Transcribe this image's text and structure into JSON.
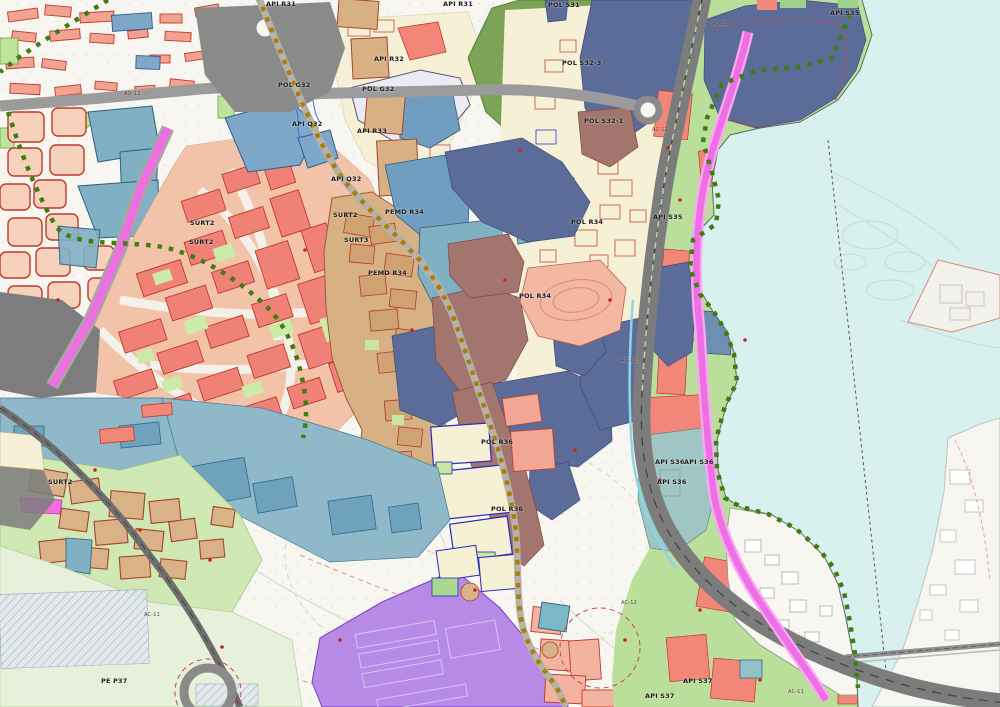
{
  "map": {
    "type": "urban-planning-zoning-map",
    "palette": {
      "water": "#d9f1ee",
      "paper": "#f8f6f0",
      "green_belt": "#b9df9b",
      "forest": "#7da356",
      "court_green": "#c8e9a4",
      "pale_green": "#e7f0da",
      "village_green": "#cfe8b4",
      "salmon_red": "#f28678",
      "estate_peach": "#f2c3a9",
      "cream": "#f6f0d6",
      "tan_historic": "#d7b183",
      "slate_blue": "#5c6c98",
      "steel_blue": "#6f9ec0",
      "teal": "#7fb0c4",
      "muted_teal": "#9fc6c4",
      "mauve": "#a2766f",
      "purple": "#b78ae6",
      "magenta_road": "#ee6fe3",
      "highway_gray": "#7c7c7c",
      "road_gray": "#9b9b9b",
      "dark_zone": "#7d7d7d",
      "gold_dotted_path": "#a87d0a",
      "green_dotted_path": "#3f7d12",
      "parcel_red_line": "#c0392b",
      "parcel_blue_line": "#2233cc"
    },
    "labels": [
      {
        "text": "API R31",
        "x": 266,
        "y": 4,
        "kind": "zone"
      },
      {
        "text": "API R31",
        "x": 443,
        "y": 4,
        "kind": "zone"
      },
      {
        "text": "POL S31",
        "x": 548,
        "y": 5,
        "kind": "zone"
      },
      {
        "text": "API S35",
        "x": 830,
        "y": 13,
        "kind": "zone"
      },
      {
        "text": "API R32",
        "x": 374,
        "y": 59,
        "kind": "zone"
      },
      {
        "text": "POL G32",
        "x": 278,
        "y": 85,
        "kind": "zone"
      },
      {
        "text": "POL G32",
        "x": 362,
        "y": 89,
        "kind": "zone"
      },
      {
        "text": "POL S32-3",
        "x": 562,
        "y": 63,
        "kind": "zone"
      },
      {
        "text": "API Q32",
        "x": 292,
        "y": 124,
        "kind": "zone"
      },
      {
        "text": "API R33",
        "x": 357,
        "y": 131,
        "kind": "zone"
      },
      {
        "text": "POL S32-1",
        "x": 584,
        "y": 121,
        "kind": "zone"
      },
      {
        "text": "API Q32",
        "x": 331,
        "y": 179,
        "kind": "zone"
      },
      {
        "text": "SURT2",
        "x": 190,
        "y": 223,
        "kind": "zone"
      },
      {
        "text": "SURT2",
        "x": 189,
        "y": 242,
        "kind": "zone"
      },
      {
        "text": "SURT2",
        "x": 333,
        "y": 215,
        "kind": "zone"
      },
      {
        "text": "SURT3",
        "x": 344,
        "y": 240,
        "kind": "zone"
      },
      {
        "text": "PEMD R34",
        "x": 385,
        "y": 212,
        "kind": "zone"
      },
      {
        "text": "PEMD R34",
        "x": 368,
        "y": 273,
        "kind": "zone"
      },
      {
        "text": "POL R34",
        "x": 571,
        "y": 222,
        "kind": "zone"
      },
      {
        "text": "API S35",
        "x": 653,
        "y": 217,
        "kind": "zone"
      },
      {
        "text": "POL R34",
        "x": 519,
        "y": 296,
        "kind": "zone"
      },
      {
        "text": "POL R36",
        "x": 481,
        "y": 442,
        "kind": "zone"
      },
      {
        "text": "API S36",
        "x": 655,
        "y": 462,
        "kind": "zone"
      },
      {
        "text": "API S36",
        "x": 684,
        "y": 462,
        "kind": "zone"
      },
      {
        "text": "API S36",
        "x": 657,
        "y": 482,
        "kind": "zone"
      },
      {
        "text": "POL R36",
        "x": 491,
        "y": 509,
        "kind": "zone"
      },
      {
        "text": "SURT2",
        "x": 48,
        "y": 482,
        "kind": "zone"
      },
      {
        "text": "PE P37",
        "x": 101,
        "y": 681,
        "kind": "zone"
      },
      {
        "text": "API S37",
        "x": 683,
        "y": 681,
        "kind": "zone"
      },
      {
        "text": "API S37",
        "x": 645,
        "y": 696,
        "kind": "zone"
      },
      {
        "text": "AO-12",
        "x": 124,
        "y": 95,
        "kind": "road"
      },
      {
        "text": "AC-12",
        "x": 712,
        "y": 25,
        "kind": "road"
      },
      {
        "text": "AC-12",
        "x": 652,
        "y": 131,
        "kind": "road"
      },
      {
        "text": "AC-12",
        "x": 621,
        "y": 362,
        "kind": "road"
      },
      {
        "text": "AC-12",
        "x": 621,
        "y": 604,
        "kind": "road"
      },
      {
        "text": "AC-11",
        "x": 788,
        "y": 693,
        "kind": "road"
      },
      {
        "text": "AC-11",
        "x": 144,
        "y": 616,
        "kind": "road"
      }
    ]
  }
}
